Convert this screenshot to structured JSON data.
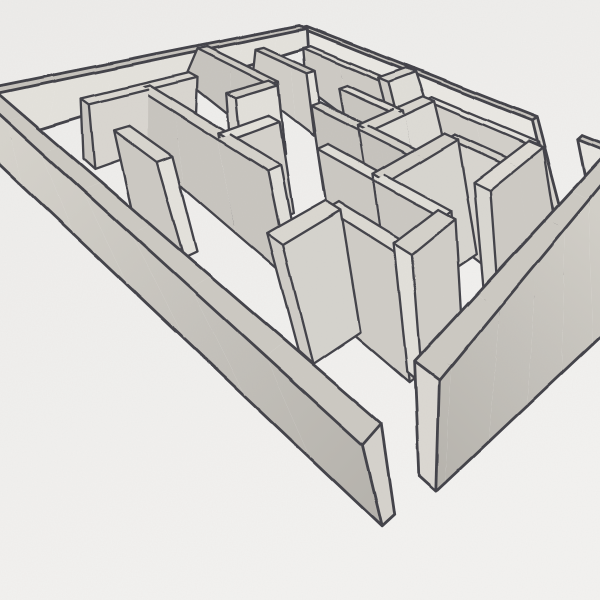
{
  "scene": {
    "subject": "hand-drawn three-dimensional maze sketch, pencil and ink on paper",
    "paper_color_top": "#edecea",
    "paper_color_bottom": "#f3f2f0",
    "ink_color": "#403f46",
    "graphite_light": "#dbd8d1",
    "graphite_mid": "#cac7c0",
    "graphite_dark": "#b6b3ad",
    "ink_width_outer": 2.8,
    "ink_width_inner": 2.3
  },
  "projection": {
    "grid_size": 7,
    "wall_thickness": 0.24,
    "rim_quad": {
      "N": [
        303,
        27
      ],
      "E": [
        618,
        152
      ],
      "S": [
        372,
        434
      ],
      "W": [
        -14,
        92
      ]
    },
    "floor_quad": {
      "N": [
        303,
        44
      ],
      "E": [
        640,
        288
      ],
      "S": [
        388,
        520
      ],
      "W": [
        -16,
        140
      ]
    }
  },
  "gradients": {
    "sw_face": {
      "from": "#d6d3cc",
      "to": "#b4b1ab",
      "x1": -10,
      "y1": 150,
      "x2": 388,
      "y2": 525
    },
    "se_face": {
      "from": "#d2cfc8",
      "to": "#b0ada7",
      "x1": 640,
      "y1": 250,
      "x2": 380,
      "y2": 520
    }
  },
  "walls": [
    {
      "name": "outer-ne-wall-left",
      "axis": "h",
      "line": 0,
      "from": 0,
      "to": 5.6,
      "top": "#c8c5be",
      "face": "#eae8e3",
      "cap": "#d8d5cf",
      "outer": true
    },
    {
      "name": "outer-ne-wall-right",
      "axis": "h",
      "line": 0,
      "from": 6.4,
      "to": 7,
      "top": "#c8c5be",
      "face": "#e7e5e0",
      "cap": "#d8d5cf",
      "outer": true
    },
    {
      "name": "outer-nw-wall",
      "axis": "v",
      "line": 0,
      "from": 0,
      "to": 7,
      "top": "#c6c3bc",
      "face": "#e4e2dc",
      "cap": "#d8d5cf",
      "outer": true
    },
    {
      "name": "outer-sw-wall",
      "axis": "h",
      "line": 7,
      "from": 0,
      "to": 7,
      "top": "#ccc9c2",
      "face": "url(#gradSW)",
      "cap": "#d5d2cc",
      "outer": true
    },
    {
      "name": "outer-se-wall",
      "axis": "v",
      "line": 7,
      "from": 0,
      "to": 6.2,
      "top": "#ccc9c2",
      "face": "url(#gradSE)",
      "cap": "#dbd8d2",
      "outer": true
    },
    {
      "name": "inner-wall-a",
      "axis": "h",
      "line": 1,
      "from": 1,
      "to": 3,
      "top": "#d9d6cf",
      "face": "#cdcac4",
      "cap": "#e2e0da"
    },
    {
      "name": "inner-wall-b",
      "axis": "h",
      "line": 1,
      "from": 4,
      "to": 6,
      "top": "#e4e2dc",
      "face": "#d2cfc9",
      "cap": "#dcd9d3"
    },
    {
      "name": "inner-wall-c",
      "axis": "v",
      "line": 3,
      "from": 0,
      "to": 1,
      "top": "#d6d3cc",
      "face": "#e0ded8",
      "cap": "#cfccc6"
    },
    {
      "name": "inner-wall-d",
      "axis": "h",
      "line": 2,
      "from": 0.6,
      "to": 2,
      "top": "#c9c6bf",
      "face": "#d0cdc7",
      "cap": "#e6e4de"
    },
    {
      "name": "inner-wall-e",
      "axis": "h",
      "line": 2,
      "from": 2.8,
      "to": 4,
      "top": "#dedbd4",
      "face": "#c9c6c0",
      "cap": "#e6e4de"
    },
    {
      "name": "inner-wall-f",
      "axis": "h",
      "line": 2,
      "from": 5,
      "to": 6,
      "top": "#d4d1ca",
      "face": "#d8d5cf",
      "cap": "#cecbc5"
    },
    {
      "name": "inner-wall-g",
      "axis": "h",
      "line": 3,
      "from": 0,
      "to": 2,
      "top": "#cfccc5",
      "face": "#c7c4be",
      "cap": "#e3e1db"
    },
    {
      "name": "inner-wall-h",
      "axis": "h",
      "line": 3,
      "from": 3,
      "to": 5,
      "top": "#d2cfc8",
      "face": "#c6c3bd",
      "cap": "#dedcd6"
    },
    {
      "name": "inner-wall-i",
      "axis": "h",
      "line": 4,
      "from": 4,
      "to": 6,
      "top": "#e0ded7",
      "face": "#cbc8c2",
      "cap": "#d7d4ce"
    },
    {
      "name": "inner-wall-j",
      "axis": "h",
      "line": 5,
      "from": 1,
      "to": 4,
      "top": "#d5d2cb",
      "face": "#c8c5bf",
      "cap": "#e1dfd9"
    },
    {
      "name": "inner-wall-k",
      "axis": "h",
      "line": 5,
      "from": 5,
      "to": 6,
      "top": "#dcd9d2",
      "face": "#cfccc6",
      "cap": "#d3d0ca"
    },
    {
      "name": "inner-wall-l",
      "axis": "h",
      "line": 6,
      "from": 2,
      "to": 3,
      "top": "#d8d5ce",
      "face": "#ccc9c3",
      "cap": "#e4e2dc"
    },
    {
      "name": "inner-wall-m",
      "axis": "v",
      "line": 1,
      "from": 4,
      "to": 6,
      "top": "#dbd8d1",
      "face": "#d9d6d0",
      "cap": "#cac7c1"
    },
    {
      "name": "inner-wall-n",
      "axis": "v",
      "line": 2,
      "from": 3,
      "to": 4,
      "top": "#d0cdc6",
      "face": "#e2e0da",
      "cap": "#d6d3cd"
    },
    {
      "name": "inner-wall-o",
      "axis": "v",
      "line": 3,
      "from": 4,
      "to": 5,
      "top": "#e3e1da",
      "face": "#d4d1cb",
      "cap": "#cdcac4"
    },
    {
      "name": "inner-wall-p",
      "axis": "v",
      "line": 4,
      "from": 1,
      "to": 3,
      "top": "#d7d4cd",
      "face": "#dddbd5",
      "cap": "#d1cec8"
    },
    {
      "name": "inner-wall-q",
      "axis": "v",
      "line": 5,
      "from": 2,
      "to": 4,
      "top": "#d3d0c9",
      "face": "#d7d5cf",
      "cap": "#e0ded8"
    },
    {
      "name": "inner-wall-r",
      "axis": "v",
      "line": 5,
      "from": 5,
      "to": 6,
      "top": "#dad7d0",
      "face": "#d5d3cd",
      "cap": "#cfccc6"
    },
    {
      "name": "inner-wall-s",
      "axis": "v",
      "line": 6,
      "from": 1,
      "to": 3,
      "top": "#dfdcd5",
      "face": "#cdcac4",
      "cap": "#d9d7d1"
    },
    {
      "name": "inner-wall-t",
      "axis": "v",
      "line": 6,
      "from": 4,
      "to": 5,
      "top": "#d4d1ca",
      "face": "#d0cdc7",
      "cap": "#e2e0da"
    }
  ]
}
